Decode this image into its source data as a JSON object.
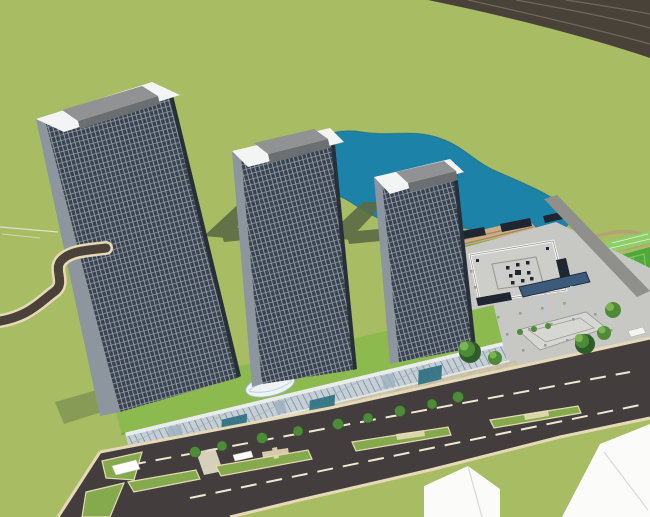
{
  "scene": {
    "type": "3d-architectural-render",
    "description": "Aerial axonometric render of a mixed-use development: three dark curtain-wall towers on a green-roofed retail podium, organic blue lake behind, formal plaza with nested-square paving motif, colonnade, sports field, tree-lined boulevard with medians, and low white buildings across the street.",
    "colors": {
      "lawn": "#a8bc64",
      "lawn_line": "#bdc78a",
      "white_streak": "#e3e6d2",
      "road_dark": "#494239",
      "road_main": "#433d3d",
      "road_gray": "#8f8f8b",
      "curb": "#e6dab6",
      "lane_dash": "#efe9d2",
      "pond": "#1d82a8",
      "pond_edge": "#14647f",
      "shadow": "#5c6a44",
      "tower_facade": "#39424e",
      "tower_grid_line": "#97a1ab",
      "tower_side": "#8d959f",
      "tower_edge_dark": "#272f3a",
      "parapet": "#f3f5f5",
      "roof_top": "#909294",
      "roof_front": "#6c6f72",
      "podium_green": "#8cba4e",
      "podium_green_dark": "#6f9a3c",
      "glass_pane": "#c5cfd7",
      "glass_mullion": "#8b959d",
      "band_white": "#e9ecee",
      "stone": "#cec4ab",
      "stone_line": "#bdb29a",
      "plaza_gray": "#c7c7c3",
      "plaza_light": "#d6d6d2",
      "plaza_dot": "#9d9d99",
      "square_line": "#97978f",
      "navy": "#1f2531",
      "colonnade": "#3c5a7a",
      "column": "#c4c8cb",
      "tree_dark": "#2f5c2b",
      "tree_mid": "#4e8a38",
      "tree_light": "#7ab54f",
      "field": "#4fa93a",
      "field_light": "#7cc763",
      "court": "#8ecf6a",
      "court_line": "#e8f2dc",
      "path_tan": "#b5a176",
      "terrace_tan": "#c9ae85",
      "terrace_brown": "#9a7a54",
      "building_white": "#fbfbf9",
      "building_edge": "#d9d9d3",
      "canopy_teal": "#2e7181",
      "atrium": "#eef3f5",
      "median_green": "#85aa4d",
      "crosswalk": "#e7e0c8"
    }
  }
}
